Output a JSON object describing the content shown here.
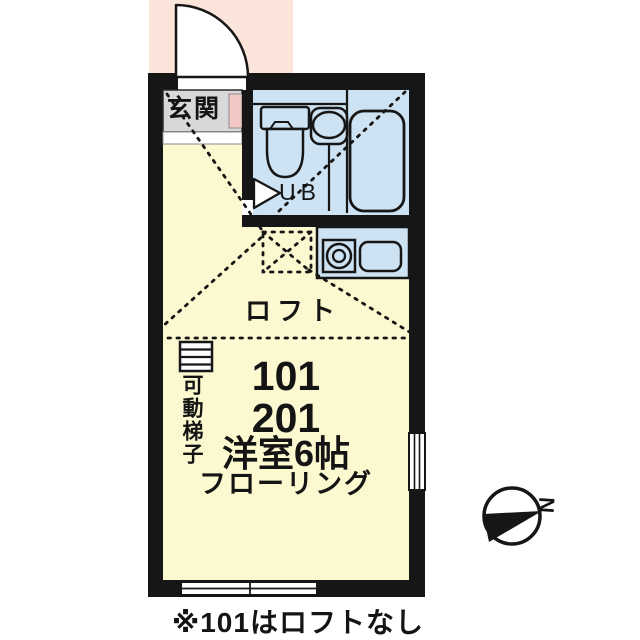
{
  "plan": {
    "entrance_label": "玄関",
    "unit_bath_label": "UB",
    "loft_label": "ロフト",
    "unit_numbers": [
      "101",
      "201"
    ],
    "room_label": "洋室6帖",
    "flooring_label": "フローリング",
    "ladder_label": "可動梯子",
    "compass_north_label": "N",
    "footnote": "※101はロフトなし"
  },
  "colors": {
    "wall": "#161616",
    "room_yellow": "#fcf8d0",
    "water_blue": "#cde2f2",
    "entry_gray": "#d8d8d8",
    "porch_pink": "#fbe4da",
    "shoebox_pink": "#f3c8c4",
    "white": "#ffffff"
  }
}
